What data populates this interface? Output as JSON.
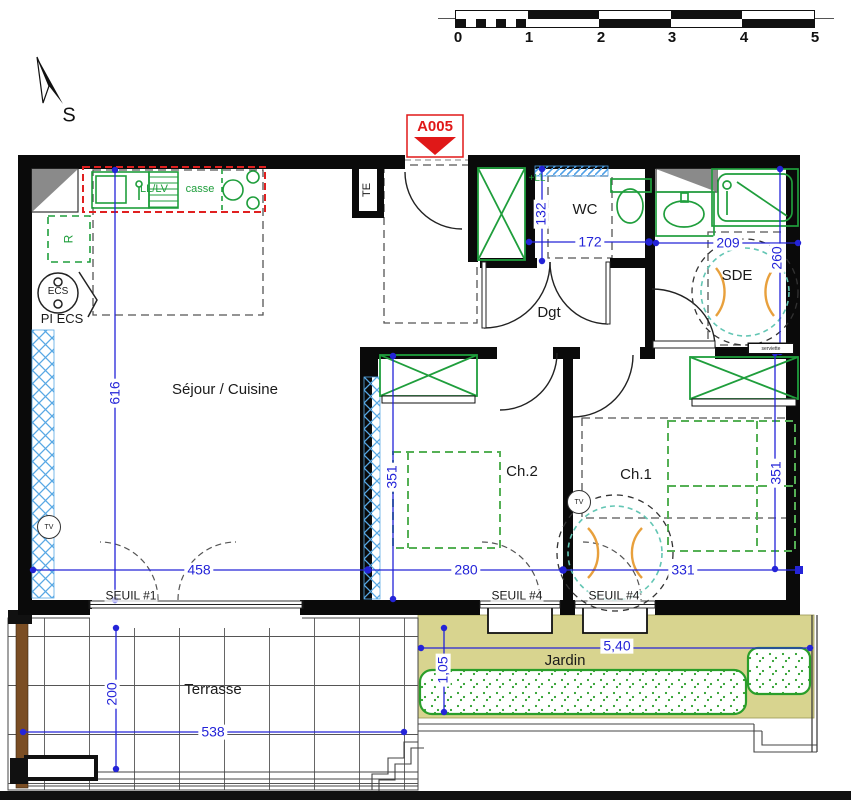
{
  "title_marker": {
    "label": "A005"
  },
  "north_arrow": {
    "label": "S"
  },
  "scale_bar": {
    "labels": [
      "0",
      "1",
      "2",
      "3",
      "4",
      "5"
    ]
  },
  "rooms": {
    "sejour_cuisine": "Séjour / Cuisine",
    "wc": "WC",
    "sde": "SDE",
    "degagement": "Dgt",
    "chambre1": "Ch.1",
    "chambre2": "Ch.2",
    "terrasse": "Terrasse",
    "jardin": "Jardin"
  },
  "thresholds": {
    "seuil_1": "SEUIL #1",
    "seuil_4_ch2": "SEUIL #4",
    "seuil_4_ch1": "SEUIL #4"
  },
  "dimensions_cm": {
    "sejour_height": "616",
    "sejour_width": "458",
    "ch2_width": "280",
    "ch1_width": "331",
    "ch2_height": "351",
    "ch1_height": "351",
    "wc_width": "172",
    "wc_height": "132",
    "sde_width": "209",
    "sde_height": "260",
    "terrasse_height": "200",
    "terrasse_width": "538"
  },
  "dimensions_m": {
    "jardin_width": "5,40",
    "jardin_height": "1,05"
  },
  "fixtures": {
    "electrical_panel": "TE",
    "washer_dishwasher": "LL/LV",
    "kitchen_drawers": "casse",
    "washer_slot": "+LL",
    "fridge": "R",
    "water_heater": "ECS",
    "water_heater_full": "PI ECS",
    "tv_living": "TV",
    "tv_bedroom": "TV",
    "towel_rail": "serviette"
  },
  "colors": {
    "dimension_blue": "#2424d8",
    "fixture_green": "#1f9e3c",
    "kitchen_red": "#e02020",
    "garden_khaki": "#d8d48f",
    "hatch_blue": "#58a8e4",
    "marker_red": "#e01818",
    "turning_teal": "#63c6b4",
    "turning_orange": "#e8a03c"
  }
}
